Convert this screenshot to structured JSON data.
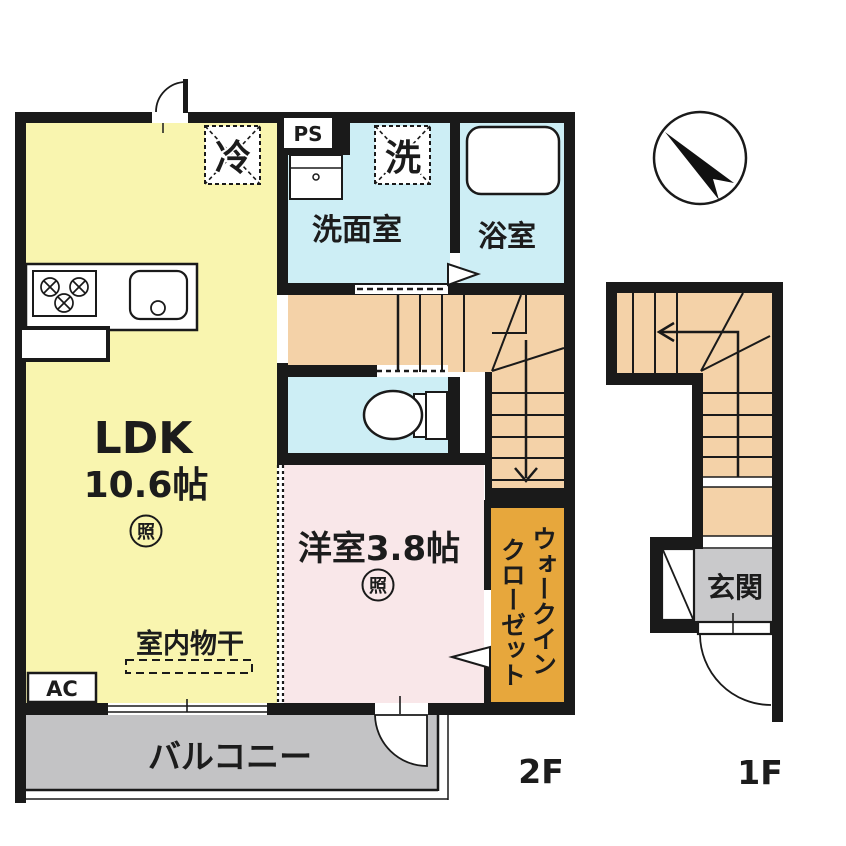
{
  "floor_2f": {
    "label": "2F",
    "rooms": {
      "ldk": {
        "name": "LDK",
        "size": "10.6帖"
      },
      "western_room": {
        "name": "洋室3.8帖"
      },
      "washroom": {
        "name": "洗面室"
      },
      "bathroom": {
        "name": "浴室"
      },
      "walk_in_closet": {
        "line1": "ウォークイン",
        "line2": "クローゼット"
      },
      "balcony": {
        "name": "バルコニー"
      }
    },
    "labels": {
      "pipe_space": "PS",
      "refrigerator": "冷",
      "washing_machine": "洗",
      "air_conditioner": "AC",
      "indoor_drying": "室内物干",
      "light": "照"
    }
  },
  "floor_1f": {
    "label": "1F",
    "rooms": {
      "entrance": {
        "name": "玄関"
      }
    }
  },
  "colors": {
    "wall": "#1a1a1a",
    "ldk": "#f9f5af",
    "wet_room": "#cdeef5",
    "western_room": "#f9e7e9",
    "stairs": "#f4d2a8",
    "closet": "#e7a73c",
    "balcony": "#c3c3c5",
    "entrance": "#c9c9cb"
  }
}
